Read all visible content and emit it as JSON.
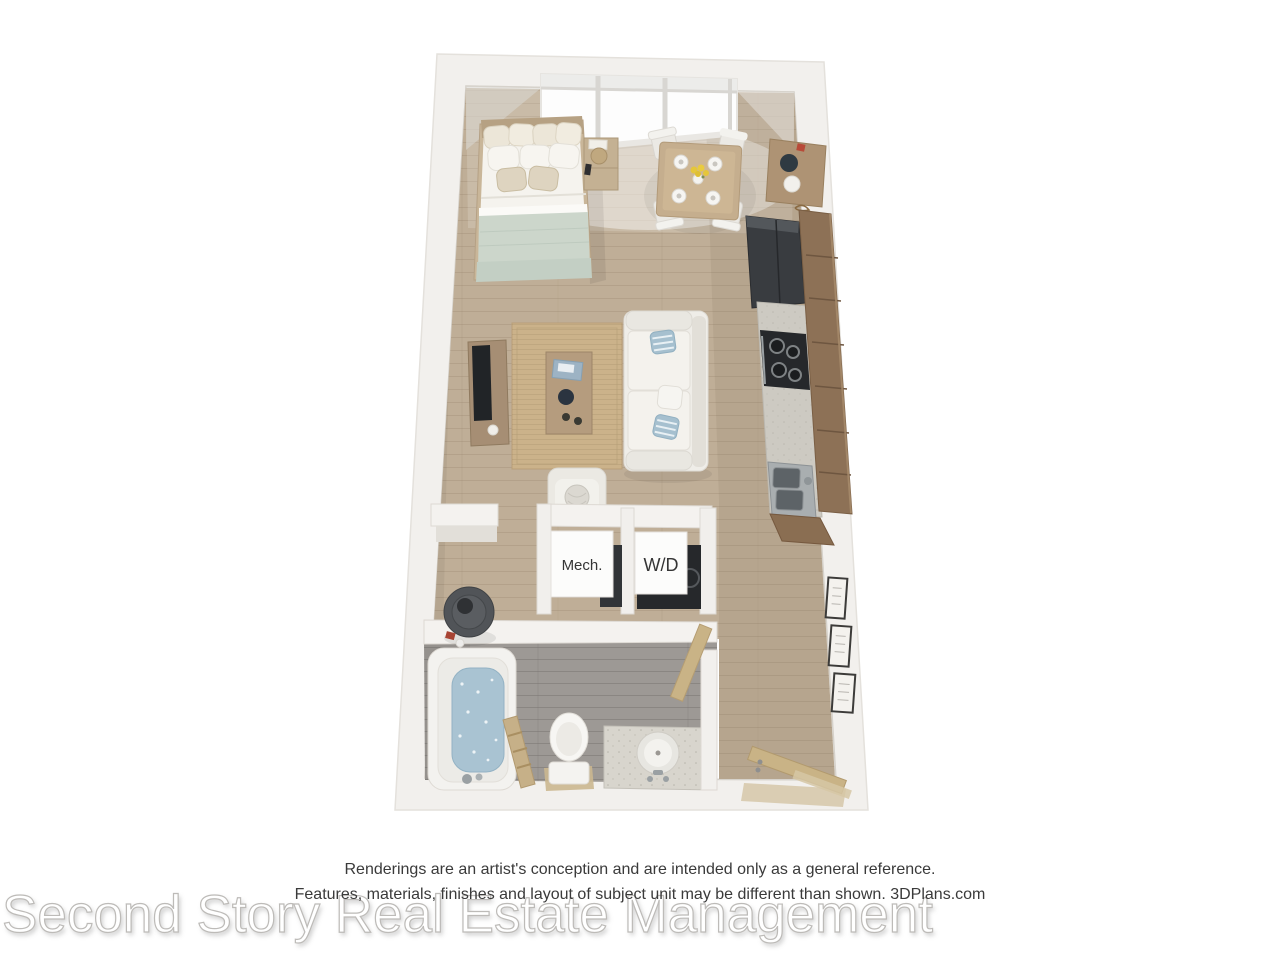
{
  "page": {
    "background": "#ffffff"
  },
  "plan": {
    "labels": {
      "mech": "Mech.",
      "washer_dryer": "W/D"
    },
    "items": [
      "window",
      "bed",
      "pillows",
      "nightstand",
      "dining-table",
      "dining-chairs",
      "tall-cabinet",
      "refrigerator",
      "upper-cabinets",
      "kitchen-counter",
      "stove",
      "kitchen-sink",
      "tv-stand",
      "tv",
      "area-rug",
      "coffee-table",
      "sofa",
      "accent-chair",
      "mech-unit",
      "washer-dryer-unit",
      "water-heater",
      "bathtub",
      "towel-ladder",
      "toilet",
      "vanity-sink",
      "bathroom-door",
      "entry-door",
      "wall-frames"
    ],
    "colors": {
      "wall": "#f2f0ed",
      "floor_wood": "#bfae97",
      "floor_bath": "#9d9995",
      "cabinet_wood": "#8d7156",
      "counter": "#cdcac2",
      "appliance_dark": "#36393d",
      "bedding_sage": "#ccd6cb",
      "accent_blue": "#a6c0cf",
      "rug": "#cbb28a",
      "door_wood": "#c9b386",
      "tub_water": "#a9c3d2"
    }
  },
  "footer": {
    "disclaimer_line1": "Renderings are an artist's conception and are intended only as a general reference.",
    "disclaimer_line2": "Features, materials, finishes and layout of subject unit may be different than shown. 3DPlans.com",
    "watermark": "Second Story Real Estate Management"
  }
}
